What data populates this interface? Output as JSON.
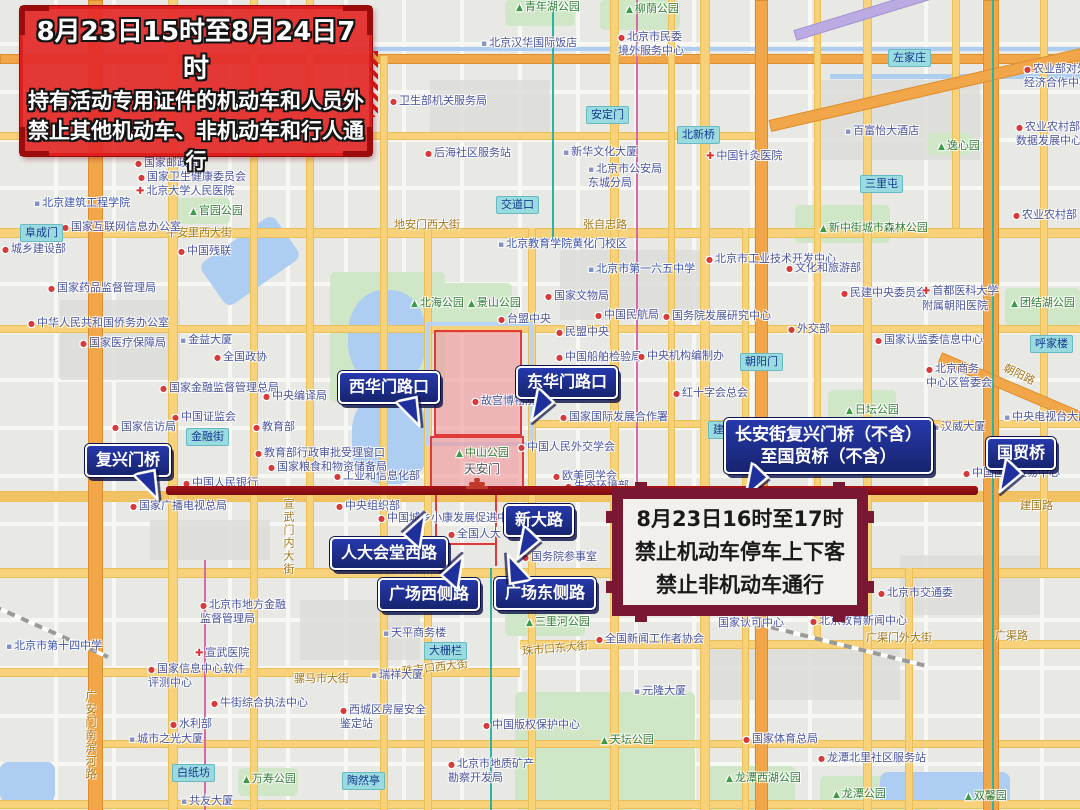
{
  "banner": {
    "line1": "8月23日15时至8月24日7时",
    "line2": "持有活动专用证件的机动车和人员外",
    "line3": "禁止其他机动车、非机动车和行人通行"
  },
  "notice": {
    "line1": "8月23日16时至17时",
    "line2": "禁止机动车停车上下客",
    "line3": "禁止非机动车通行"
  },
  "colors": {
    "restriction_line": "#8e1014",
    "callout_bg": "#1f2f9c",
    "banner_red": "#e32a2a",
    "notice_frame": "#7a1733",
    "zone_fill": "#f2a9ad",
    "zone_border": "#e03b3b"
  },
  "callouts": [
    {
      "id": "fuxingmen-bridge",
      "lines": [
        "复兴门桥"
      ],
      "x": 85,
      "y": 444,
      "tail": "down-right",
      "big": false
    },
    {
      "id": "xihuamen-crossing",
      "lines": [
        "西华门路口"
      ],
      "x": 338,
      "y": 371,
      "tail": "down-right",
      "big": false
    },
    {
      "id": "donghuamen-crossing",
      "lines": [
        "东华门路口"
      ],
      "x": 516,
      "y": 366,
      "tail": "down-left",
      "big": false
    },
    {
      "id": "changan-range",
      "lines": [
        "长安街复兴门桥（不含）",
        "至国贸桥（不含）"
      ],
      "x": 724,
      "y": 418,
      "tail": "down-left",
      "big": true
    },
    {
      "id": "guomao-bridge",
      "lines": [
        "国贸桥"
      ],
      "x": 986,
      "y": 437,
      "tail": "down-left",
      "big": false
    },
    {
      "id": "xindalu",
      "lines": [
        "新大路"
      ],
      "x": 504,
      "y": 504,
      "tail": "down-left",
      "big": false
    },
    {
      "id": "renda-west-road",
      "lines": [
        "人大会堂西路"
      ],
      "x": 330,
      "y": 537,
      "tail": "up-right",
      "big": false
    },
    {
      "id": "square-west-road",
      "lines": [
        "广场西侧路"
      ],
      "x": 378,
      "y": 578,
      "tail": "up-right",
      "big": false
    },
    {
      "id": "square-east-road",
      "lines": [
        "广场东侧路"
      ],
      "x": 494,
      "y": 577,
      "tail": "up-left",
      "big": false
    }
  ],
  "map": {
    "stations": [
      {
        "t": "阜成门",
        "x": 20,
        "y": 224
      },
      {
        "t": "金融街",
        "x": 186,
        "y": 428
      },
      {
        "t": "白纸坊",
        "x": 172,
        "y": 764
      },
      {
        "t": "陶然亭",
        "x": 342,
        "y": 772
      },
      {
        "t": "大栅栏",
        "x": 424,
        "y": 642
      },
      {
        "t": "交道口",
        "x": 496,
        "y": 196
      },
      {
        "t": "安定门",
        "x": 586,
        "y": 106
      },
      {
        "t": "北新桥",
        "x": 677,
        "y": 126
      },
      {
        "t": "左家庄",
        "x": 888,
        "y": 49
      },
      {
        "t": "三里屯",
        "x": 860,
        "y": 175
      },
      {
        "t": "呼家楼",
        "x": 1030,
        "y": 335
      },
      {
        "t": "朝阳门",
        "x": 740,
        "y": 353
      },
      {
        "t": "建国门",
        "x": 708,
        "y": 421
      }
    ],
    "road_names": [
      {
        "t": "平安里西大街",
        "x": 166,
        "y": 224
      },
      {
        "t": "地安门西大街",
        "x": 394,
        "y": 216
      },
      {
        "t": "张自忠路",
        "x": 583,
        "y": 216
      },
      {
        "t": "前门西大街",
        "x": 393,
        "y": 560
      },
      {
        "t": "珠市口西大街",
        "x": 402,
        "y": 659,
        "rot": -7
      },
      {
        "t": "珠市口东大街",
        "x": 522,
        "y": 640,
        "rot": -5
      },
      {
        "t": "骡马市大街",
        "x": 294,
        "y": 670
      },
      {
        "t": "广渠门外大街",
        "x": 866,
        "y": 629
      },
      {
        "t": "广渠路",
        "x": 995,
        "y": 627
      },
      {
        "t": "朝阳路",
        "x": 1003,
        "y": 366,
        "rot": 26
      },
      {
        "t": "建国路",
        "x": 1020,
        "y": 497
      },
      {
        "t": "宣武门内大街",
        "x": 280,
        "y": 498,
        "vert": true
      },
      {
        "t": "广安门南滨河路",
        "x": 82,
        "y": 690,
        "vert": true
      }
    ],
    "pois": [
      {
        "t": "国家邮政局",
        "x": 135,
        "y": 156,
        "k": "dot"
      },
      {
        "t": "国家卫生健康委员会",
        "x": 138,
        "y": 170,
        "k": "dot"
      },
      {
        "t": "北京大学人民医院",
        "x": 136,
        "y": 184,
        "k": "hosp"
      },
      {
        "t": "北京建筑工程学院",
        "x": 34,
        "y": 196,
        "k": "school"
      },
      {
        "t": "官园公园",
        "x": 190,
        "y": 204,
        "k": "park"
      },
      {
        "t": "国家互联网信息办公室",
        "x": 62,
        "y": 220,
        "k": "dot"
      },
      {
        "t": "城乡建设部",
        "x": 2,
        "y": 242,
        "k": "dot"
      },
      {
        "t": "中国残联",
        "x": 178,
        "y": 244,
        "k": "dot"
      },
      {
        "t": "国家药品监督管理局",
        "x": 48,
        "y": 281,
        "k": "dot"
      },
      {
        "t": "中华人民共和国侨务办公室",
        "x": 28,
        "y": 316,
        "k": "dot"
      },
      {
        "t": "国家医疗保障局",
        "x": 80,
        "y": 336,
        "k": "dot"
      },
      {
        "t": "金益大厦",
        "x": 180,
        "y": 333,
        "k": "bld"
      },
      {
        "t": "全国政协",
        "x": 214,
        "y": 350,
        "k": "dot"
      },
      {
        "t": "国家金融监督管理总局",
        "x": 160,
        "y": 381,
        "k": "dot"
      },
      {
        "t": "中央编译局",
        "x": 263,
        "y": 389,
        "k": "dot"
      },
      {
        "t": "中国证监会",
        "x": 172,
        "y": 410,
        "k": "dot"
      },
      {
        "t": "国家信访局",
        "x": 112,
        "y": 420,
        "k": "dot"
      },
      {
        "t": "教育部",
        "x": 253,
        "y": 420,
        "k": "dot"
      },
      {
        "t": "教育部行政审批受理窗口",
        "x": 255,
        "y": 446,
        "k": "dot"
      },
      {
        "t": "中国人民银行",
        "x": 183,
        "y": 476,
        "k": "dot"
      },
      {
        "t": "工业和信息化部",
        "x": 334,
        "y": 469,
        "k": "dot"
      },
      {
        "t": "国家粮食和物资储备局",
        "x": 268,
        "y": 460,
        "k": "dot"
      },
      {
        "t": "国家广播电视总局",
        "x": 130,
        "y": 499,
        "k": "dot"
      },
      {
        "t": "中央组织部",
        "x": 336,
        "y": 499,
        "k": "dot"
      },
      {
        "t": "北海公园",
        "x": 411,
        "y": 296,
        "k": "park"
      },
      {
        "t": "景山公园",
        "x": 468,
        "y": 296,
        "k": "park"
      },
      {
        "t": "台盟中央",
        "x": 498,
        "y": 312,
        "k": "dot"
      },
      {
        "t": "国家文物局",
        "x": 545,
        "y": 289,
        "k": "dot"
      },
      {
        "t": "中国民航局",
        "x": 595,
        "y": 308,
        "k": "dot"
      },
      {
        "t": "民盟中央",
        "x": 556,
        "y": 325,
        "k": "dot"
      },
      {
        "t": "中国船舶检验局",
        "x": 556,
        "y": 350,
        "k": "dot"
      },
      {
        "t": "中央机构编制办",
        "x": 638,
        "y": 349,
        "k": "dot"
      },
      {
        "t": "国务院发展研究中心",
        "x": 663,
        "y": 309,
        "k": "dot"
      },
      {
        "t": "北京市第一六五中学",
        "x": 588,
        "y": 262,
        "k": "school"
      },
      {
        "t": "北京教育学院黄化门校区",
        "x": 498,
        "y": 237,
        "k": "school"
      },
      {
        "t": "北京市工业技术开发中心",
        "x": 706,
        "y": 252,
        "k": "dot"
      },
      {
        "t": "文化和旅游部",
        "x": 786,
        "y": 261,
        "k": "dot"
      },
      {
        "t": "外交部",
        "x": 788,
        "y": 322,
        "k": "dot"
      },
      {
        "t": "红十字会总会",
        "x": 673,
        "y": 386,
        "k": "dot"
      },
      {
        "t": "国家国际发展合作署",
        "x": 560,
        "y": 410,
        "k": "dot"
      },
      {
        "t": "故宫博物院",
        "x": 472,
        "y": 394,
        "k": "dot"
      },
      {
        "t": "中山公园",
        "x": 456,
        "y": 446,
        "k": "park"
      },
      {
        "t": "天安门",
        "x": 464,
        "y": 462,
        "k": "place"
      },
      {
        "t": "中国人民外交学会",
        "x": 518,
        "y": 440,
        "k": "dot"
      },
      {
        "t": "欧美同学会",
        "x": 553,
        "y": 469,
        "k": "dot"
      },
      {
        "t": "生态环境部",
        "x": 565,
        "y": 479,
        "k": "dot"
      },
      {
        "t": "中国城乡小康发展促进中心",
        "x": 378,
        "y": 511,
        "k": "dot"
      },
      {
        "t": "全国人大",
        "x": 448,
        "y": 527,
        "k": "dot"
      },
      {
        "t": "国务院参事室",
        "x": 522,
        "y": 550,
        "k": "dot"
      },
      {
        "t": "民建中央委员会",
        "x": 841,
        "y": 286,
        "k": "dot"
      },
      {
        "lines": [
          "首都医科大学",
          "附属朝阳医院"
        ],
        "x": 922,
        "y": 284,
        "k": "hosp"
      },
      {
        "t": "团结湖公园",
        "x": 1011,
        "y": 296,
        "k": "park"
      },
      {
        "t": "国家认监委信息中心",
        "x": 875,
        "y": 333,
        "k": "dot"
      },
      {
        "lines": [
          "北京商务",
          "中心区管委会"
        ],
        "x": 926,
        "y": 362,
        "k": "dot"
      },
      {
        "t": "日坛公园",
        "x": 846,
        "y": 403,
        "k": "park"
      },
      {
        "t": "汉威大厦",
        "x": 933,
        "y": 420,
        "k": "bld"
      },
      {
        "t": "中央电视台大厦",
        "x": 1004,
        "y": 410,
        "k": "bld"
      },
      {
        "t": "中国国际贸易中心",
        "x": 963,
        "y": 466,
        "k": "dot"
      },
      {
        "lines": [
          "中国合格评定",
          "国家认可中心"
        ],
        "x": 718,
        "y": 602,
        "k": "dot"
      },
      {
        "t": "北京教育新闻中心",
        "x": 810,
        "y": 614,
        "k": "dot"
      },
      {
        "t": "北京市交通委",
        "x": 878,
        "y": 586,
        "k": "dot"
      },
      {
        "t": "国家体育总局",
        "x": 743,
        "y": 732,
        "k": "dot"
      },
      {
        "t": "龙潭北里社区服务站",
        "x": 818,
        "y": 751,
        "k": "dot"
      },
      {
        "t": "龙潭西湖公园",
        "x": 726,
        "y": 771,
        "k": "park"
      },
      {
        "t": "龙潭公园",
        "x": 833,
        "y": 787,
        "k": "park"
      },
      {
        "t": "双馨园",
        "x": 965,
        "y": 789,
        "k": "park"
      },
      {
        "t": "天坛公园",
        "x": 601,
        "y": 733,
        "k": "park"
      },
      {
        "t": "中国版权保护中心",
        "x": 483,
        "y": 718,
        "k": "dot"
      },
      {
        "lines": [
          "北京市地质矿产",
          "勘察开发局"
        ],
        "x": 448,
        "y": 757,
        "k": "dot"
      },
      {
        "t": "三里河公园",
        "x": 526,
        "y": 615,
        "k": "park"
      },
      {
        "t": "全国新闻工作者协会",
        "x": 596,
        "y": 632,
        "k": "dot"
      },
      {
        "t": "天平商务楼",
        "x": 383,
        "y": 626,
        "k": "bld"
      },
      {
        "t": "瑞祥大厦",
        "x": 371,
        "y": 668,
        "k": "bld"
      },
      {
        "t": "元隆大厦",
        "x": 634,
        "y": 684,
        "k": "bld"
      },
      {
        "lines": [
          "西城区房屋安全",
          "鉴定站"
        ],
        "x": 340,
        "y": 703,
        "k": "dot"
      },
      {
        "t": "北京市第十四中学",
        "x": 6,
        "y": 639,
        "k": "school"
      },
      {
        "lines": [
          "北京市地方金融",
          "监督管理局"
        ],
        "x": 200,
        "y": 598,
        "k": "dot"
      },
      {
        "t": "宣武医院",
        "x": 195,
        "y": 646,
        "k": "hosp"
      },
      {
        "lines": [
          "国家信息中心软件",
          "评测中心"
        ],
        "x": 148,
        "y": 662,
        "k": "dot"
      },
      {
        "t": "牛街综合执法中心",
        "x": 211,
        "y": 696,
        "k": "dot"
      },
      {
        "t": "水利部",
        "x": 170,
        "y": 717,
        "k": "dot"
      },
      {
        "t": "城市之光大厦",
        "x": 129,
        "y": 732,
        "k": "bld"
      },
      {
        "t": "万寿公园",
        "x": 243,
        "y": 772,
        "k": "park"
      },
      {
        "t": "共友大厦",
        "x": 181,
        "y": 794,
        "k": "bld"
      },
      {
        "t": "农业农村部",
        "x": 1013,
        "y": 208,
        "k": "dot"
      },
      {
        "lines": [
          "农业农村部大",
          "数据发展中心"
        ],
        "x": 1016,
        "y": 120,
        "k": "dot"
      },
      {
        "lines": [
          "农业部对外",
          "经济合作中心"
        ],
        "x": 1024,
        "y": 62,
        "k": "dot"
      },
      {
        "t": "新中街城市森林公园",
        "x": 820,
        "y": 221,
        "k": "park"
      },
      {
        "t": "逸心园",
        "x": 938,
        "y": 139,
        "k": "park"
      },
      {
        "t": "百富怡大酒店",
        "x": 845,
        "y": 124,
        "k": "bld"
      },
      {
        "t": "青年湖公园",
        "x": 516,
        "y": 0,
        "k": "park"
      },
      {
        "t": "柳荫公园",
        "x": 626,
        "y": 2,
        "k": "park"
      },
      {
        "t": "北京汉华国际饭店",
        "x": 481,
        "y": 36,
        "k": "bld"
      },
      {
        "lines": [
          "北京市民委",
          "境外服务中心"
        ],
        "x": 618,
        "y": 30,
        "k": "dot"
      },
      {
        "t": "卫生部机关服务局",
        "x": 390,
        "y": 94,
        "k": "dot"
      },
      {
        "t": "后海社区服务站",
        "x": 425,
        "y": 146,
        "k": "dot"
      },
      {
        "t": "新华文化大厦",
        "x": 563,
        "y": 145,
        "k": "bld"
      },
      {
        "lines": [
          "北京市公安局",
          "东城分局"
        ],
        "x": 588,
        "y": 162,
        "k": "bld"
      },
      {
        "t": "中国针灸医院",
        "x": 706,
        "y": 149,
        "k": "hosp"
      }
    ]
  }
}
